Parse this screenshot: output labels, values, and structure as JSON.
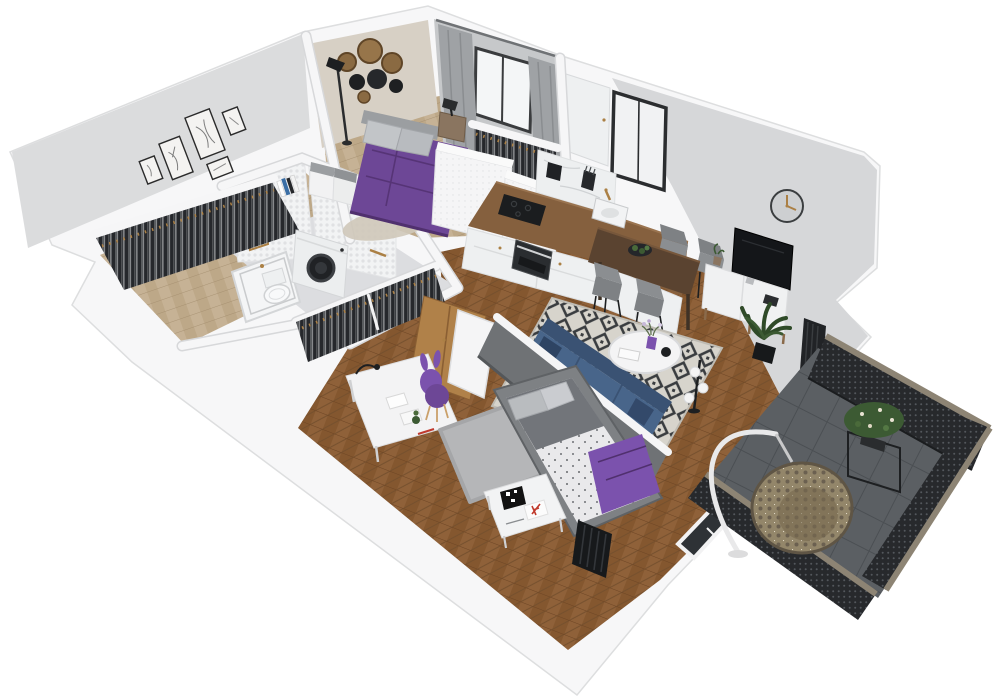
{
  "scene": {
    "title": "3D apartment floor plan render",
    "style": "isometric dollhouse cutaway, viewed from above at an angle, rotated counter-clockwise",
    "background": "#ffffff"
  },
  "colors": {
    "background": "#ffffff",
    "wall_top": "#f7f7f8",
    "wall_face": "#d6d7d9",
    "wall_art": "#dbdcdd",
    "wall_beige": "#d7d0c5",
    "wall_shade": "#c9cbcd",
    "wood_light": "#c6b295",
    "wood_main": "#8a5c36",
    "wood_dark": "#6d4524",
    "floor_bath": "#dcdde0",
    "tile_white": "#f2f3f4",
    "balcony_floor": "#5b5f63",
    "railing_dark": "#27292c",
    "railing_frame": "#8d8474",
    "rug_light": "#d7d4cc",
    "rug_dark": "#3a3d40",
    "rug_gray": "#b5b6b8",
    "sofa_blue": "#48658a",
    "sofa_dark": "#3a5273",
    "purple": "#6d4796",
    "purple_dark": "#50306e",
    "purple_light": "#7b52ad",
    "counter_wood": "#85603e",
    "table_wood": "#5a4330",
    "cabinet_white": "#eef0f1",
    "chair_gray": "#7e8184",
    "partition_gray": "#6f7275",
    "plant_green": "#3c5a33",
    "gold": "#ab8045",
    "black": "#1d1f21",
    "marble": "#edeff0",
    "curtain": "#9fa2a5"
  },
  "rooms": [
    {
      "id": "bedroom",
      "label": "Bedroom",
      "floor": "light wood",
      "furniture": [
        "double bed with purple bedding",
        "gray pillows",
        "nightstand with black reading lamp",
        "black floor lamp",
        "round wood-slice and mirror wall decor",
        "gray curtains with window",
        "white dotted wardrobe",
        "open clothes rack",
        "two white poufs with gray cushions",
        "beige rug"
      ]
    },
    {
      "id": "hallway",
      "label": "Entry hall",
      "floor": "light wood",
      "furniture": [
        "open wardrobe with dark hanging clothes",
        "books on shelf",
        "gallery wall with five framed line-art prints"
      ]
    },
    {
      "id": "bathroom",
      "label": "Bathroom",
      "floor": "gray stone tile",
      "furniture": [
        "bathtub",
        "toilet",
        "washing machine with black door",
        "white penny-tile walls",
        "gold framed mirror",
        "gold towel bar"
      ]
    },
    {
      "id": "kitchen",
      "label": "Kitchen",
      "floor": "herringbone oak",
      "furniture": [
        "L-shaped white base cabinets",
        "wooden countertop",
        "black cooktop",
        "oven",
        "sink with gold faucet",
        "marble backsplash",
        "black kettle",
        "knife block",
        "tall white cabinet",
        "window with sheer curtain"
      ]
    },
    {
      "id": "dining",
      "label": "Dining area",
      "floor": "herringbone oak",
      "furniture": [
        "dark wooden bar table",
        "four gray chairs with black legs",
        "black plate with succulents"
      ]
    },
    {
      "id": "living",
      "label": "Living room",
      "floor": "herringbone oak",
      "furniture": [
        "blue sofa with navy pillows",
        "round white coffee table",
        "purple vase with flowers",
        "black bowl",
        "black-and-white diamond rug",
        "white TV sideboard",
        "flat-screen television",
        "round wall clock with gold hands",
        "tall potted plant",
        "floor lamp with white globes",
        "black radiator"
      ]
    },
    {
      "id": "kids-bedroom",
      "label": "Second bedroom",
      "floor": "herringbone oak",
      "furniture": [
        "single bed with speckled duvet and purple throw",
        "gray headboard partition wall",
        "white desk with black lamp and papers",
        "purple bunny-ear chair",
        "gray rug",
        "white side table",
        "QR-pattern artwork",
        "red letter print",
        "open clothes rack",
        "oak wardrobe",
        "white interior door",
        "glass balcony door"
      ]
    },
    {
      "id": "balcony",
      "label": "Balcony",
      "floor": "dark gray tile",
      "furniture": [
        "hanging rattan egg chair on white stand",
        "black plant stand with flowering shrub",
        "dark perforated metal railing with taupe top rail"
      ]
    }
  ]
}
